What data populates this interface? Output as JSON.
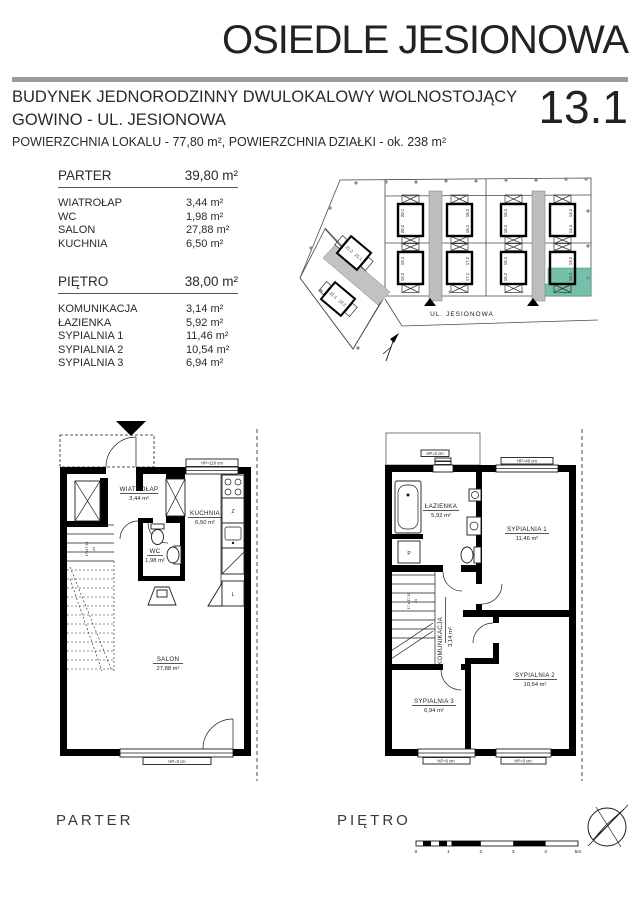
{
  "header": {
    "title": "OSIEDLE JESIONOWA",
    "subtitle_line1": "BUDYNEK JEDNORODZINNY DWULOKALOWY WOLNOSTOJĄCY",
    "subtitle_line2": "GOWINO - UL. JESIONOWA",
    "area_line": "POWIERZCHNIA LOKALU - 77,80 m², POWIERZCHNIA DZIAŁKI - ok. 238 m²",
    "unit_number": "13.1"
  },
  "floors": {
    "parter": {
      "name": "PARTER",
      "total_area": "39,80 m²",
      "rooms": [
        {
          "label": "WIATROŁAP",
          "area": "3,44 m²"
        },
        {
          "label": "WC",
          "area": "1,98 m²"
        },
        {
          "label": "SALON",
          "area": "27,88 m²"
        },
        {
          "label": "KUCHNIA",
          "area": "6,50 m²"
        }
      ]
    },
    "pietro": {
      "name": "PIĘTRO",
      "total_area": "38,00 m²",
      "rooms": [
        {
          "label": "KOMUNIKACJA",
          "area": "3,14 m²"
        },
        {
          "label": "ŁAZIENKA",
          "area": "5,92 m²"
        },
        {
          "label": "SYPIALNIA 1",
          "area": "11,46 m²"
        },
        {
          "label": "SYPIALNIA 2",
          "area": "10,54 m²"
        },
        {
          "label": "SYPIALNIA 3",
          "area": "6,94 m²"
        }
      ]
    }
  },
  "site_plan": {
    "street_label": "UL. JESIONOWA",
    "highlighted_unit": "13.1",
    "highlight_color": "#74c0ab",
    "units": [
      "20.1",
      "20.2",
      "19.1",
      "19.2",
      "18.2",
      "18.1",
      "17.2",
      "17.1",
      "16.1",
      "16.2",
      "15.1",
      "15.2",
      "14.2",
      "14.1",
      "13.2",
      "13.1",
      "21.2",
      "21.1",
      "22.1",
      "22.2"
    ]
  },
  "parter_plan": {
    "rooms": {
      "wiatrolap": {
        "name": "WIATROŁAP",
        "area": "3,44 m²"
      },
      "wc": {
        "name": "WC",
        "area": "1,98 m²"
      },
      "kuchnia": {
        "name": "KUCHNIA",
        "area": "6,50 m²"
      },
      "salon": {
        "name": "SALON",
        "area": "27,88 m²"
      }
    },
    "labels": {
      "window_top": "HP=110 cm",
      "window_bottom": "HP=0 cm",
      "stairs": "17x17,35",
      "stairs_tread": "24",
      "dishwasher": "Z",
      "fridge": "L"
    }
  },
  "pietro_plan": {
    "rooms": {
      "lazienka": {
        "name": "ŁAZIENKA",
        "area": "5,92 m²"
      },
      "komunikacja": {
        "name": "KOMUNIKACJA",
        "area": "3,14 m²"
      },
      "sypialnia1": {
        "name": "SYPIALNIA 1",
        "area": "11,46 m²"
      },
      "sypialnia2": {
        "name": "SYPIALNIA 2",
        "area": "10,54 m²"
      },
      "sypialnia3": {
        "name": "SYPIALNIA 3",
        "area": "6,94 m²"
      }
    },
    "labels": {
      "window_top_left": "HP=0 cm",
      "window_top_right": "HP=40 cm",
      "window_bottom_left": "HP=0 cm",
      "window_bottom_right": "HP=0 cm",
      "stairs": "17 x 17,35",
      "stairs_tread": "24",
      "washer": "P"
    }
  },
  "footer": {
    "parter_label": "PARTER",
    "pietro_label": "PIĘTRO",
    "scale_ticks": [
      "0",
      "1",
      "2",
      "3",
      "4",
      "5m"
    ]
  },
  "colors": {
    "rule_gray": "#9b9b9b",
    "driveway": "#bdbdbd",
    "road": "#c2c2c2"
  }
}
